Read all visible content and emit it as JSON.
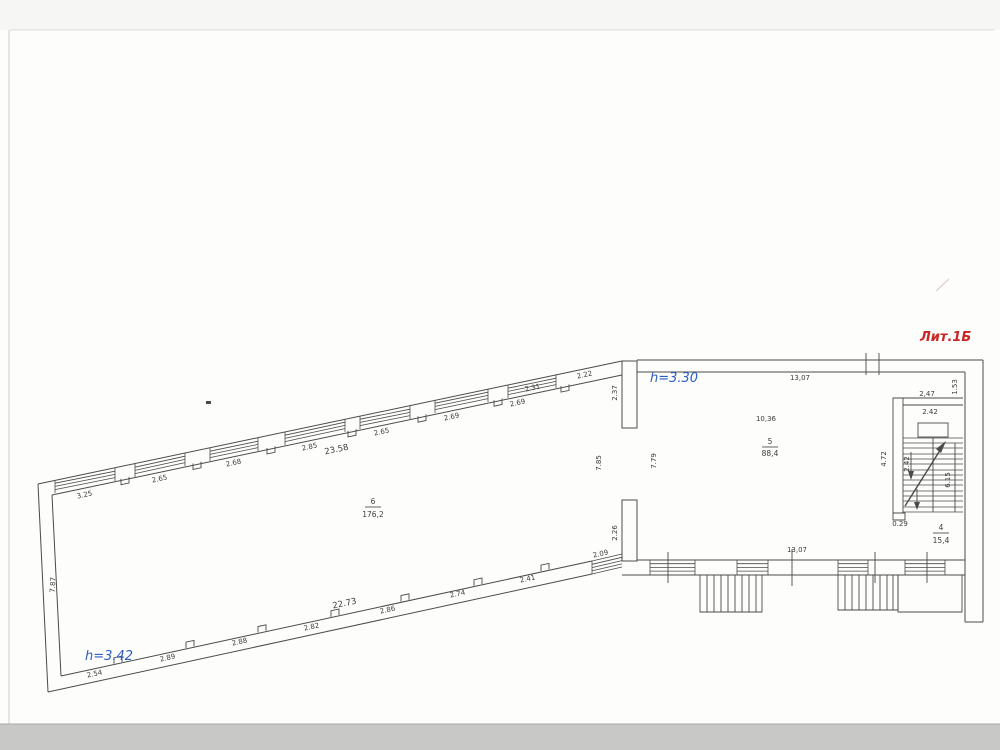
{
  "plan": {
    "litera": "Лит.1Б",
    "heights": {
      "left_wing": "h=3.42",
      "right_wing": "h=3.30"
    },
    "rooms": {
      "room6": {
        "num": "6",
        "area": "176,2"
      },
      "room5": {
        "num": "5",
        "area": "88,4"
      },
      "room4": {
        "num": "4",
        "area": "15,4"
      }
    },
    "dims": {
      "top": [
        "3.25",
        "2.65",
        "2.68",
        "2.85",
        "2.65",
        "2.69",
        "2.69",
        "2.31",
        "2.22"
      ],
      "top_total": "23.58",
      "bottom": [
        "2.54",
        "2.89",
        "2.88",
        "2.82",
        "2.86",
        "2.74",
        "2.41"
      ],
      "bottom_total": "22.73",
      "door": "2.09",
      "left_wall": "7.87",
      "pier_top": "2.37",
      "pier_bottom": "2.26",
      "hall_left": "7.85",
      "hall_right": "7.79",
      "right_top": "13,07",
      "right_bottom": "13,07",
      "room5_width": "10,36",
      "stair_top": "2,47",
      "stair_inner_top": "2.42",
      "stair_left": "4.72",
      "stair_flight": "2.42",
      "stair_right": "6.15",
      "stair_corner": "1.53",
      "stair_bottom": "0.29"
    }
  },
  "colors": {
    "line": "#4a4a4a",
    "blue": "#2d5dc2",
    "red": "#cc2525"
  }
}
